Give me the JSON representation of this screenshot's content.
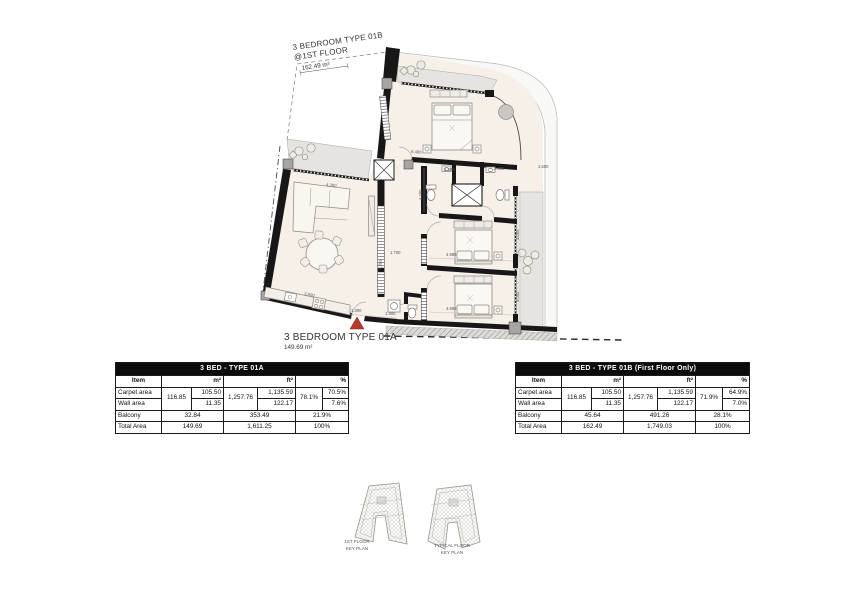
{
  "plan": {
    "type_b": {
      "line1": "3 BEDROOM TYPE 01B",
      "line2": "@1ST FLOOR",
      "area": "162.49 m²"
    },
    "type_a": {
      "name": "3 BEDROOM TYPE 01A",
      "area": "149.69 m²"
    },
    "dims": {
      "a": "6.400",
      "b": "2.500",
      "c": "2.400",
      "d": "1.500",
      "e": "4.200",
      "f": "1.700",
      "g": "4.985",
      "h": "3.005",
      "i": "5.005",
      "j": "4.965",
      "k": "1.300",
      "l": "1.900",
      "m": "4.200",
      "n": "3.500",
      "o": "1.385"
    },
    "colors": {
      "wall": "#171717",
      "room": "#f7f0e8",
      "balcony": "#e6e4e0",
      "facade_band": "#f8f8f6",
      "entry_marker": "#b8392d"
    }
  },
  "tables": {
    "a": {
      "title": "3 BED - TYPE 01A",
      "h_item": "Item",
      "h_m2": "m²",
      "h_ft2": "ft²",
      "h_pct": "%",
      "carpet": "Carpet area",
      "wall": "Wall area",
      "balcony": "Balcony",
      "total": "Total Area",
      "m2_group": "116.85",
      "carpet_m2": "105.50",
      "wall_m2": "11.35",
      "ft2_group": "1,257.76",
      "carpet_ft2": "1,135.59",
      "wall_ft2": "122.17",
      "pct_group": "78.1%",
      "carpet_pct": "70.5%",
      "wall_pct": "7.6%",
      "balcony_m2": "32.84",
      "balcony_ft2": "353.49",
      "balcony_pct": "21.9%",
      "total_m2": "149.69",
      "total_ft2": "1,611.25",
      "total_pct": "100%"
    },
    "b": {
      "title": "3 BED - TYPE 01B (First Floor Only)",
      "h_item": "Item",
      "h_m2": "m²",
      "h_ft2": "ft²",
      "h_pct": "%",
      "carpet": "Carpet area",
      "wall": "Wall area",
      "balcony": "Balcony",
      "total": "Total Area",
      "m2_group": "116.85",
      "carpet_m2": "105.50",
      "wall_m2": "11.35",
      "ft2_group": "1,257.76",
      "carpet_ft2": "1,135.59",
      "wall_ft2": "122.17",
      "pct_group": "71.9%",
      "carpet_pct": "64.9%",
      "wall_pct": "7.0%",
      "balcony_m2": "45.64",
      "balcony_ft2": "491.26",
      "balcony_pct": "28.1%",
      "total_m2": "162.49",
      "total_ft2": "1,749.03",
      "total_pct": "100%"
    }
  },
  "key_plans": {
    "first": {
      "line1": "1ST FLOOR",
      "line2": "KEY PLAN"
    },
    "typical": {
      "line1": "TYPICAL FLOOR",
      "line2": "KEY PLAN"
    }
  }
}
